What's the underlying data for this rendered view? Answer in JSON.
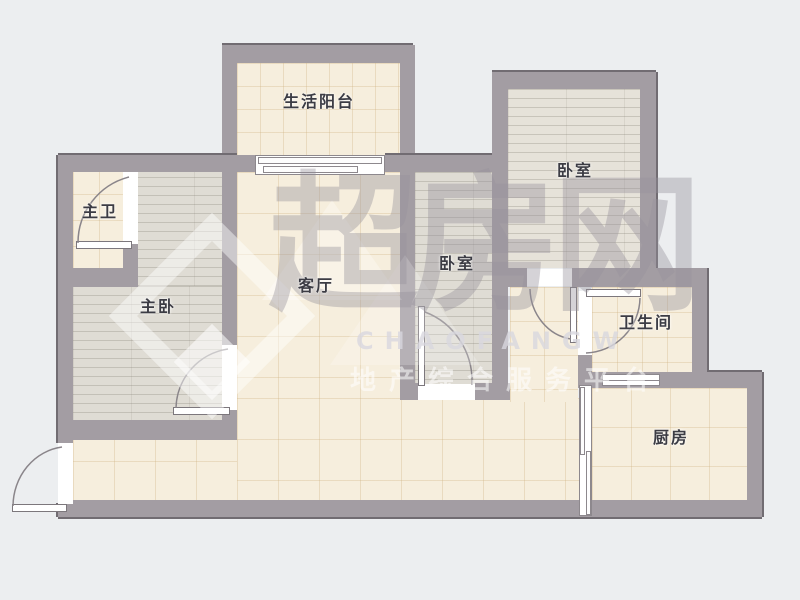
{
  "plan": {
    "rooms": {
      "balcony": {
        "label": "生活阳台"
      },
      "master_bath": {
        "label": "主卫"
      },
      "master_bedroom": {
        "label": "主卧"
      },
      "living_room": {
        "label": "客厅"
      },
      "bedroom_center": {
        "label": "卧室"
      },
      "bedroom_top_right": {
        "label": "卧室"
      },
      "bathroom": {
        "label": "卫生间"
      },
      "kitchen": {
        "label": "厨房"
      }
    }
  },
  "watermark": {
    "brand": "超房网",
    "latin": "CHAOFANGW",
    "slogan": "地产综合服务平台"
  },
  "colors": {
    "bg": "#eceef0",
    "wall": "#a39da3",
    "tile": "#f6eedd",
    "wood": "#dfdcd4",
    "wood_light": "#e6e2d9",
    "door": "#ffffff"
  }
}
